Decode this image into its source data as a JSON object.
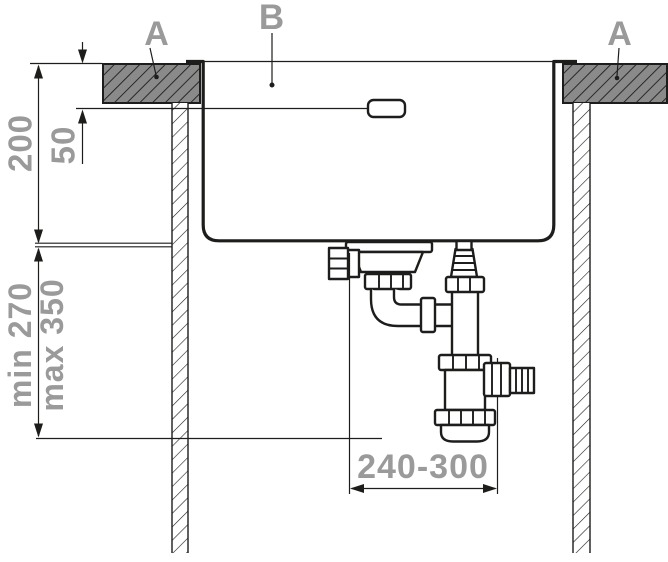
{
  "diagram": {
    "callouts": [
      {
        "id": "countertop-left",
        "label": "A"
      },
      {
        "id": "sink-basin",
        "label": "B"
      },
      {
        "id": "countertop-right",
        "label": "A"
      }
    ],
    "dimensions": [
      {
        "id": "sink-depth",
        "label": "200"
      },
      {
        "id": "overflow-offset",
        "label": "50"
      },
      {
        "id": "drain-height-min",
        "label": "min 270"
      },
      {
        "id": "drain-height-max",
        "label": "max 350"
      },
      {
        "id": "outlet-distance",
        "label": "240-300"
      }
    ],
    "colors": {
      "label_gray": "#9a9a9a",
      "line_black": "#1d1d1b",
      "counter_fill": "#8a8a8a",
      "background": "#ffffff"
    }
  }
}
